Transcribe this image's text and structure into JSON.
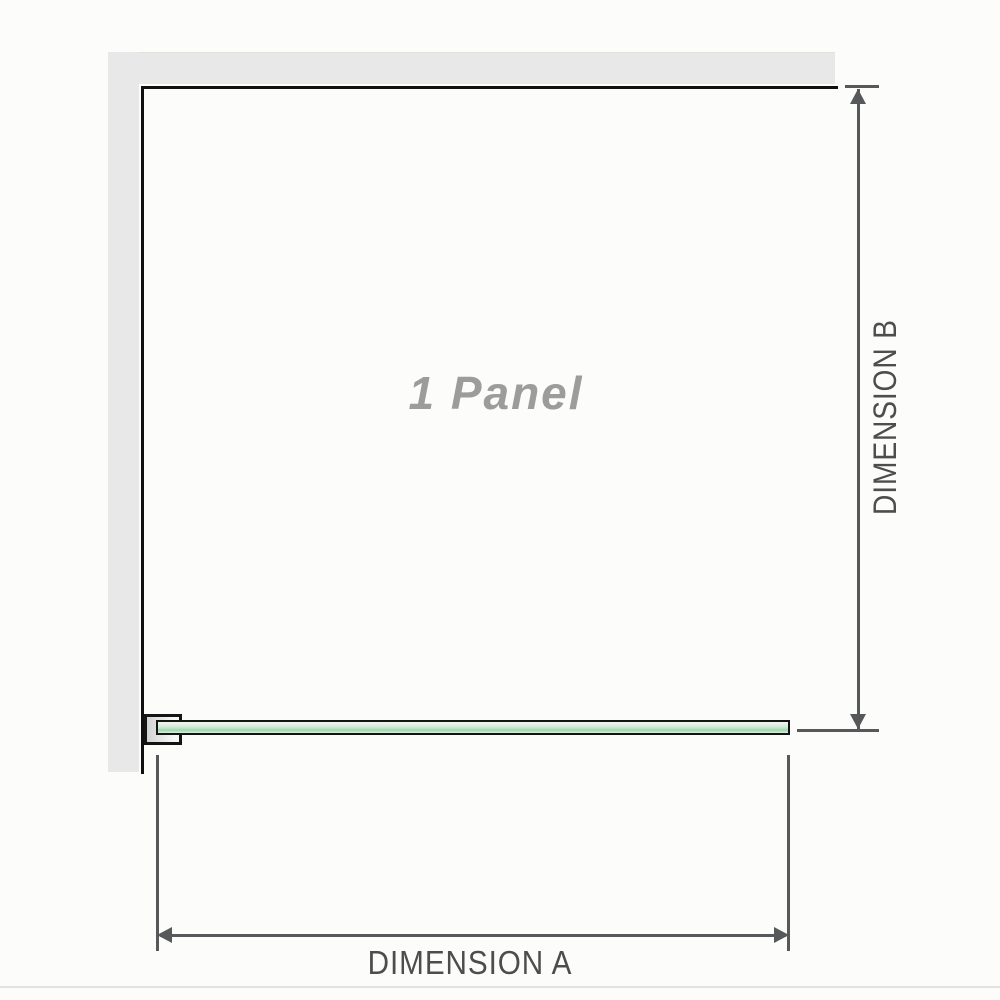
{
  "diagram": {
    "panel_label": "1 Panel",
    "dimension_a_label": "DIMENSION A",
    "dimension_b_label": "DIMENSION B"
  },
  "colors": {
    "background": "#fcfcfa",
    "wall": "#e8e8e8",
    "wall_edge": "#101010",
    "dimension": "#57585a",
    "label_text": "#4d4d4d",
    "panel_label_text": "#9c9c9c",
    "glass_border": "#141414",
    "glass_light": "#d6eddc",
    "glass_dark": "#a0d5af",
    "bracket_fill": "#d2d2d2",
    "divider": "#e2e2de"
  }
}
